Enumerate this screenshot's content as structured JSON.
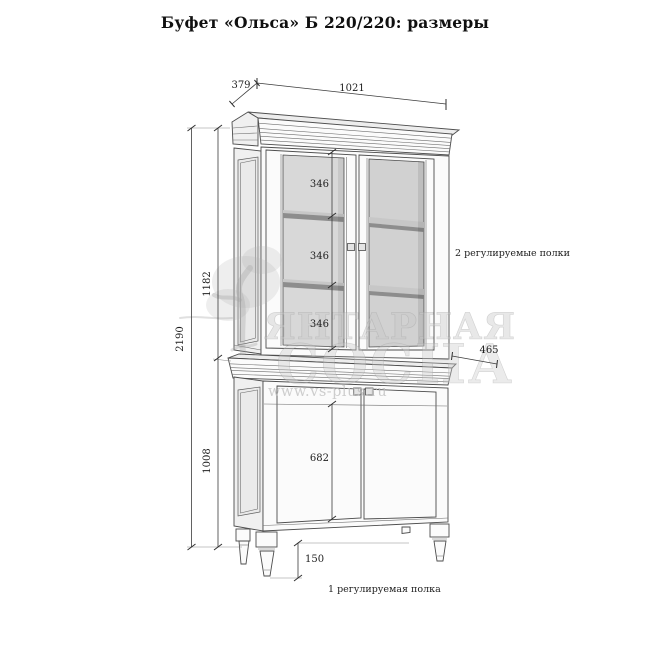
{
  "title": "Буфет «Ольса» Б 220/220: размеры",
  "diagram": {
    "type": "furniture-dimension-drawing",
    "product": "Буфет «Ольса» Б 220/220",
    "dimensions_mm": {
      "top_depth": "379",
      "top_width": "1021",
      "total_height": "2190",
      "upper_section_height": "1182",
      "lower_section_height": "1008",
      "shelf_sections": [
        "346",
        "346",
        "346"
      ],
      "lower_depth": "465",
      "lower_door_height": "682",
      "leg_height": "150"
    },
    "annotations": {
      "upper_shelves": "2 регулируемые полки",
      "lower_shelf": "1 регулируемая полка"
    }
  },
  "watermark": {
    "brand_line1": "ЯНТАРНАЯ",
    "brand_line2": "СОСНА",
    "url": "www.vs-plus.ru"
  },
  "colors": {
    "line": "#4d4d4d",
    "glass": "#d6d6d6",
    "shelf_edge": "#8d8d8d",
    "watermark_gray": "#c8c8c8",
    "background": "#ffffff"
  }
}
